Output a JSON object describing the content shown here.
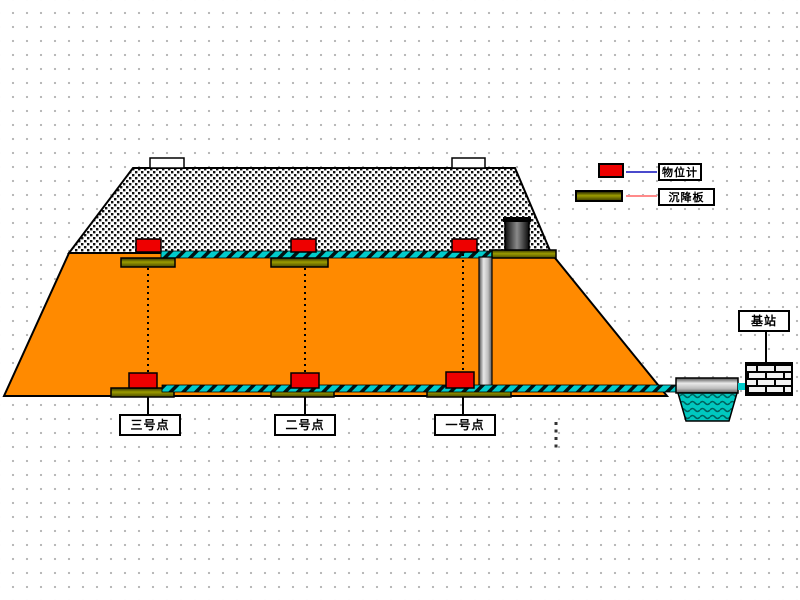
{
  "title": "embankment-settlement-monitoring-diagram",
  "legend": {
    "items": [
      {
        "id": "level-gauge",
        "label": "物位计",
        "swatch_color": "#ee0000",
        "line_color": "#4a4acc"
      },
      {
        "id": "settlement-plate",
        "label": "沉降板",
        "swatch_color": "#6b6b00",
        "line_color": "#ff8a8a"
      }
    ]
  },
  "points": [
    {
      "label": "三号点"
    },
    {
      "label": "二号点"
    },
    {
      "label": "一号点"
    }
  ],
  "station": {
    "label": "基站"
  },
  "colors": {
    "embankment_fill": "#ff8a00",
    "sensor_red": "#ee0000",
    "plate_olive": "#6b6b00",
    "conduit_cyan": "#00cccc",
    "water_teal": "#00c8c0",
    "pipe_gray": "#bdbdbd",
    "background": "#ffffff",
    "grid_dot": "#b9b9b9"
  }
}
